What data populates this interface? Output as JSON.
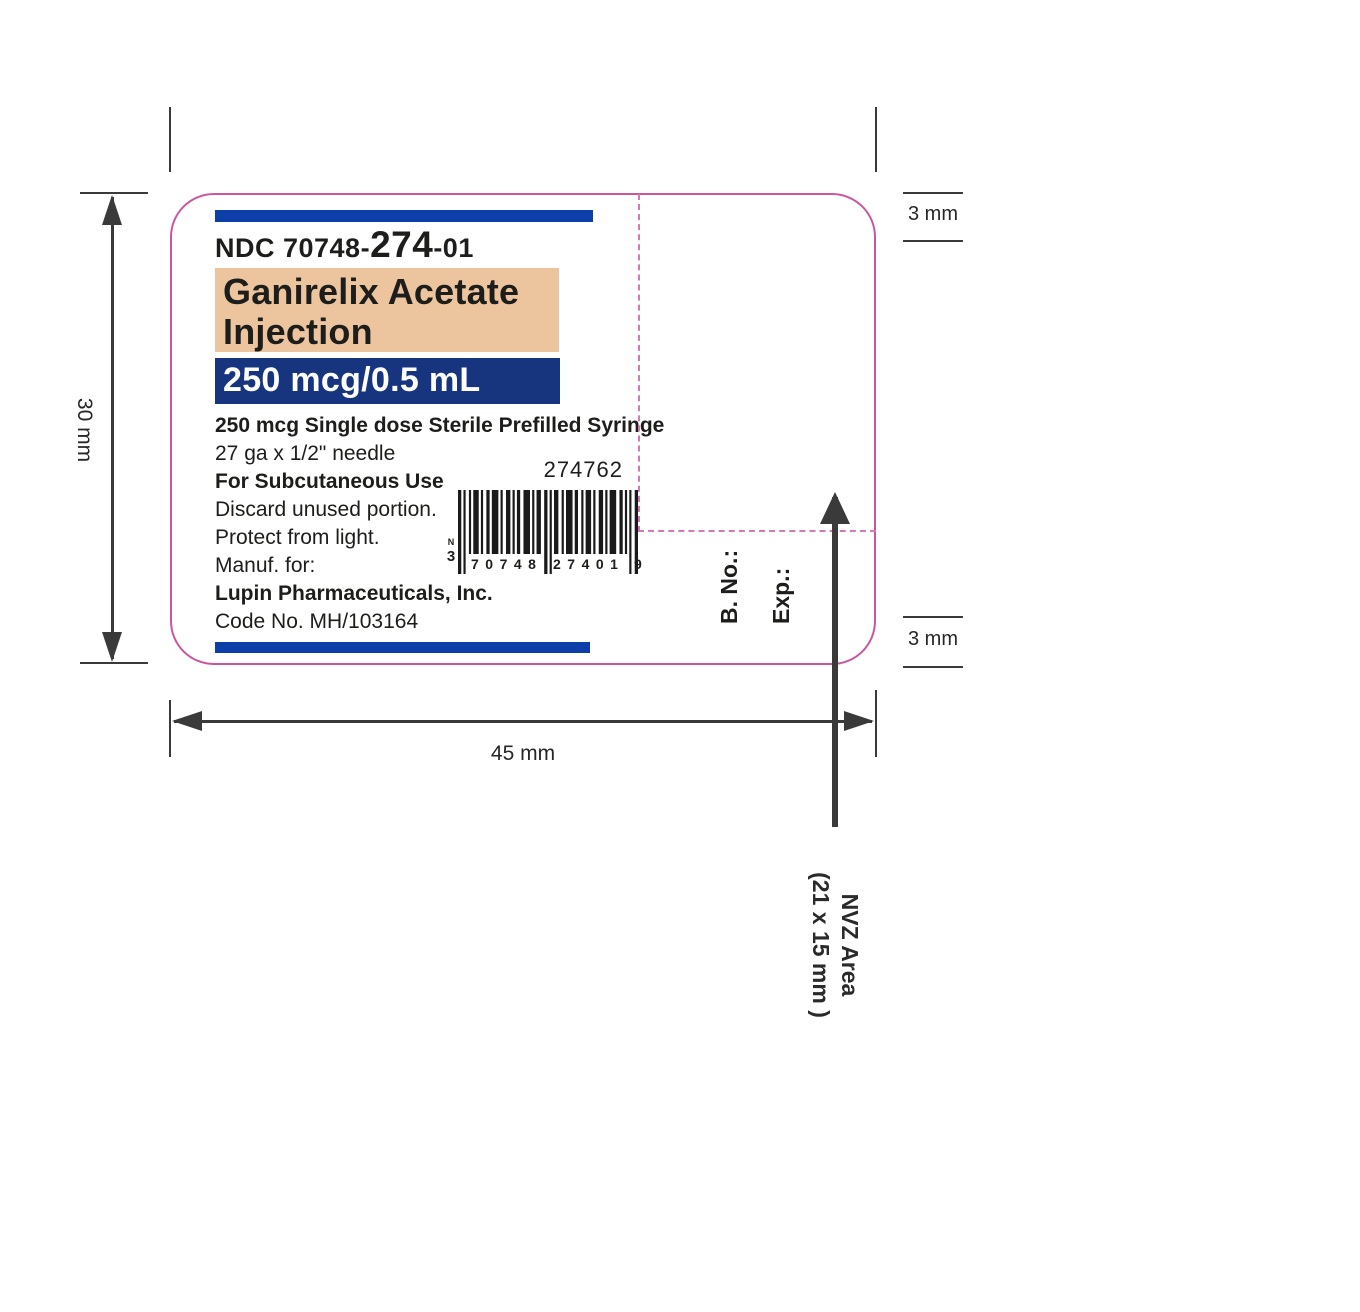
{
  "label": {
    "ndc": {
      "prefix": "NDC 70748-",
      "mid": "274",
      "suffix": "-01"
    },
    "drug_name_line1": "Ganirelix Acetate",
    "drug_name_line2": "Injection",
    "strength": "250 mcg/0.5 mL",
    "body_lines": [
      "250 mcg Single dose Sterile Prefilled Syringe",
      "27 ga x 1/2\" needle",
      "For Subcutaneous Use",
      "Discard unused portion.",
      "Protect from light.",
      "Manuf. for:",
      "Lupin Pharmaceuticals, Inc.",
      "Code No. MH/103164"
    ],
    "item_number": "274762",
    "barcode": {
      "prefix_letter": "N",
      "lead_digit": "3",
      "group1": "70748",
      "group2": "27401",
      "check_digit": "9"
    },
    "batch_label": "B. No.:",
    "exp_label": "Exp.:"
  },
  "annotations": {
    "width_label": "45 mm",
    "height_label": "30 mm",
    "margin_top_label": "3 mm",
    "margin_bottom_label": "3 mm",
    "nvz_line1": "NVZ Area",
    "nvz_line2": "(21 x 15 mm )"
  },
  "colors": {
    "bar_blue": "#0d3ea8",
    "strength_blue": "#17357f",
    "drug_name_tan": "#ecc49e",
    "label_outline_magenta": "#c9579f",
    "nvz_dash_magenta": "#d678b4",
    "ink_black": "#1d1d1b"
  }
}
